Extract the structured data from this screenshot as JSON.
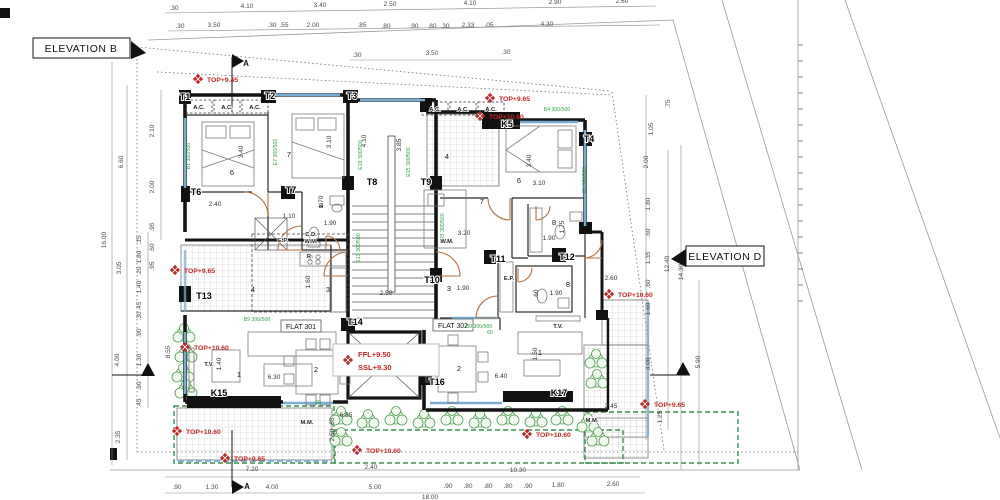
{
  "labels": {
    "elevation_b": "ELEVATION B",
    "elevation_d": "ELEVATION D",
    "flat_301": "FLAT 301",
    "flat_302": "FLAT 302"
  },
  "levels": {
    "ffl": "FFL+9.50",
    "ssl": "SSL+9.30"
  },
  "section_labels": [
    {
      "t": "A",
      "x": 246,
      "y": 66
    },
    {
      "t": "A",
      "x": 247,
      "y": 489
    }
  ],
  "red_markers": [
    {
      "t": "TOP+9.45",
      "x": 207,
      "y": 82
    },
    {
      "t": "TOP+9.65",
      "x": 499,
      "y": 101
    },
    {
      "t": "TOP+10.60",
      "x": 489,
      "y": 119
    },
    {
      "t": "TOP+9.65",
      "x": 184,
      "y": 273
    },
    {
      "t": "TOP+10.60",
      "x": 194,
      "y": 350
    },
    {
      "t": "TOP+10.60",
      "x": 186,
      "y": 434
    },
    {
      "t": "TOP+9.65",
      "x": 234,
      "y": 461
    },
    {
      "t": "TOP+10.60",
      "x": 366,
      "y": 453
    },
    {
      "t": "TOP+10.60",
      "x": 536,
      "y": 437
    },
    {
      "t": "TOP+10.60",
      "x": 618,
      "y": 297
    },
    {
      "t": "TOP+9.65",
      "x": 654,
      "y": 407
    }
  ],
  "columns": [
    {
      "t": "T1",
      "x": 185,
      "y": 100
    },
    {
      "t": "T2",
      "x": 270,
      "y": 99
    },
    {
      "t": "T3",
      "x": 352,
      "y": 99
    },
    {
      "t": "T4",
      "x": 589,
      "y": 142
    },
    {
      "t": "T6",
      "x": 196,
      "y": 195
    },
    {
      "t": "T7",
      "x": 291,
      "y": 193
    },
    {
      "t": "T8",
      "x": 372,
      "y": 185
    },
    {
      "t": "T9",
      "x": 426,
      "y": 185
    },
    {
      "t": "T10",
      "x": 432,
      "y": 283
    },
    {
      "t": "T11",
      "x": 498,
      "y": 262
    },
    {
      "t": "T12",
      "x": 567,
      "y": 260
    },
    {
      "t": "T13",
      "x": 204,
      "y": 299
    },
    {
      "t": "T14",
      "x": 355,
      "y": 325
    },
    {
      "t": "T16",
      "x": 437,
      "y": 385
    },
    {
      "t": "K5",
      "x": 507,
      "y": 127
    },
    {
      "t": "K15",
      "x": 219,
      "y": 396
    },
    {
      "t": "K17",
      "x": 559,
      "y": 396
    }
  ],
  "rooms": [
    {
      "t": "6",
      "x": 232,
      "y": 175
    },
    {
      "t": "7",
      "x": 289,
      "y": 157
    },
    {
      "t": "8",
      "x": 321,
      "y": 208
    },
    {
      "t": "3",
      "x": 328,
      "y": 292
    },
    {
      "t": "4",
      "x": 253,
      "y": 292
    },
    {
      "t": "1",
      "x": 239,
      "y": 377
    },
    {
      "t": "2",
      "x": 316,
      "y": 372
    },
    {
      "t": "4",
      "x": 447,
      "y": 159
    },
    {
      "t": "6",
      "x": 519,
      "y": 183
    },
    {
      "t": "7",
      "x": 482,
      "y": 204
    },
    {
      "t": "8",
      "x": 554,
      "y": 225
    },
    {
      "t": "8",
      "x": 568,
      "y": 287
    },
    {
      "t": "3",
      "x": 449,
      "y": 291
    },
    {
      "t": "1",
      "x": 540,
      "y": 355
    },
    {
      "t": "2",
      "x": 459,
      "y": 371
    }
  ],
  "annotations": [
    {
      "t": "A.C.",
      "x": 199,
      "y": 109
    },
    {
      "t": "A.C.",
      "x": 227,
      "y": 109
    },
    {
      "t": "A.C.",
      "x": 255,
      "y": 109
    },
    {
      "t": "A.C.",
      "x": 435,
      "y": 111
    },
    {
      "t": "A.C.",
      "x": 463,
      "y": 111
    },
    {
      "t": "A.C.",
      "x": 491,
      "y": 111
    },
    {
      "t": "E.P.",
      "x": 283,
      "y": 242
    },
    {
      "t": "E.P.",
      "x": 509,
      "y": 280
    },
    {
      "t": "C.D.",
      "x": 311,
      "y": 236
    },
    {
      "t": "W.M.",
      "x": 311,
      "y": 243
    },
    {
      "t": "W.M.",
      "x": 447,
      "y": 243
    },
    {
      "t": "T.V.",
      "x": 209,
      "y": 366
    },
    {
      "t": "T.V.",
      "x": 558,
      "y": 328
    },
    {
      "t": "M.M.",
      "x": 307,
      "y": 424
    },
    {
      "t": "M.M.",
      "x": 592,
      "y": 422
    },
    {
      "t": "R",
      "x": 309,
      "y": 258
    }
  ],
  "green_codes": [
    {
      "t": "B1 300/500",
      "x": 190,
      "y": 156,
      "r": -90
    },
    {
      "t": "E7 300/500",
      "x": 277,
      "y": 152,
      "r": -90
    },
    {
      "t": "E19 300/500",
      "x": 362,
      "y": 155,
      "r": -90
    },
    {
      "t": "E15 300/500",
      "x": 410,
      "y": 162,
      "r": -90
    },
    {
      "t": "B4 300/500",
      "x": 557,
      "y": 111
    },
    {
      "t": "E13 300/500",
      "x": 360,
      "y": 248,
      "r": -90
    },
    {
      "t": "E23 300/500",
      "x": 444,
      "y": 228,
      "r": -90
    },
    {
      "t": "E5 300/500",
      "x": 586,
      "y": 180,
      "r": -90
    },
    {
      "t": "B9 300/500",
      "x": 257,
      "y": 321
    },
    {
      "t": "B9 300/500",
      "x": 479,
      "y": 328
    },
    {
      "t": "60",
      "x": 318,
      "y": 404
    },
    {
      "t": "60",
      "x": 490,
      "y": 334
    }
  ],
  "dims_top": [
    {
      "t": ".30",
      "x": 174,
      "y": 10
    },
    {
      "t": "4.10",
      "x": 247,
      "y": 8
    },
    {
      "t": "3.40",
      "x": 320,
      "y": 7
    },
    {
      "t": "2.50",
      "x": 390,
      "y": 6
    },
    {
      "t": "4.10",
      "x": 470,
      "y": 5
    },
    {
      "t": "2.90",
      "x": 555,
      "y": 4
    },
    {
      "t": "2.60",
      "x": 622,
      "y": 3
    }
  ],
  "dims_top2": [
    {
      "t": ".30",
      "x": 180,
      "y": 28
    },
    {
      "t": "3.50",
      "x": 214,
      "y": 27
    },
    {
      "t": ".30",
      "x": 272,
      "y": 27
    },
    {
      "t": ".55",
      "x": 284,
      "y": 27
    },
    {
      "t": "2.00",
      "x": 313,
      "y": 27
    },
    {
      "t": ".85",
      "x": 362,
      "y": 27
    },
    {
      "t": ".80",
      "x": 386,
      "y": 28
    },
    {
      "t": ".90",
      "x": 414,
      "y": 28
    },
    {
      "t": ".80",
      "x": 432,
      "y": 28
    },
    {
      "t": ".30",
      "x": 445,
      "y": 28
    },
    {
      "t": "2.33",
      "x": 468,
      "y": 27
    },
    {
      "t": ".05",
      "x": 489,
      "y": 27
    },
    {
      "t": "4.30",
      "x": 547,
      "y": 26
    }
  ],
  "dims_top3": [
    {
      "t": ".30",
      "x": 357,
      "y": 57
    },
    {
      "t": "3.50",
      "x": 432,
      "y": 55
    },
    {
      "t": ".30",
      "x": 506,
      "y": 54
    }
  ],
  "dims_bottom": [
    {
      "t": "7.20",
      "x": 252,
      "y": 471
    },
    {
      "t": "2.40",
      "x": 371,
      "y": 469
    },
    {
      "t": "10.30",
      "x": 518,
      "y": 472
    }
  ],
  "dims_bottom2": [
    {
      "t": ".90",
      "x": 177,
      "y": 489
    },
    {
      "t": "1.30",
      "x": 212,
      "y": 489
    },
    {
      "t": "4.00",
      "x": 272,
      "y": 489
    },
    {
      "t": "5.00",
      "x": 375,
      "y": 489
    },
    {
      "t": ".90",
      "x": 448,
      "y": 488
    },
    {
      "t": ".80",
      "x": 468,
      "y": 488
    },
    {
      "t": ".80",
      "x": 488,
      "y": 488
    },
    {
      "t": ".80",
      "x": 508,
      "y": 488
    },
    {
      "t": ".90",
      "x": 528,
      "y": 488
    },
    {
      "t": "1.80",
      "x": 558,
      "y": 487
    },
    {
      "t": "2.60",
      "x": 613,
      "y": 486
    }
  ],
  "dims_bottom3": [
    {
      "t": "18.00",
      "x": 430,
      "y": 499
    }
  ],
  "dims_left": [
    {
      "t": "16.00",
      "x": 106,
      "y": 240,
      "r": -90
    },
    {
      "t": "6.60",
      "x": 123,
      "y": 162,
      "r": -90
    },
    {
      "t": "3.05",
      "x": 121,
      "y": 268,
      "r": -90
    },
    {
      "t": "4.00",
      "x": 119,
      "y": 360,
      "r": -90
    },
    {
      "t": "2.35",
      "x": 120,
      "y": 437,
      "r": -90
    },
    {
      "t": "2.10",
      "x": 154,
      "y": 131,
      "r": -90
    },
    {
      "t": "2.00",
      "x": 154,
      "y": 187,
      "r": -90
    },
    {
      "t": ".95",
      "x": 154,
      "y": 227,
      "r": -90
    },
    {
      "t": ".60",
      "x": 154,
      "y": 248,
      "r": -90
    },
    {
      "t": ".95",
      "x": 154,
      "y": 266,
      "r": -90
    },
    {
      "t": ".15",
      "x": 141,
      "y": 240,
      "r": -90
    },
    {
      "t": "1.80",
      "x": 141,
      "y": 257,
      "r": -90
    },
    {
      "t": ".20",
      "x": 141,
      "y": 271,
      "r": -90
    },
    {
      "t": "1.40",
      "x": 141,
      "y": 287,
      "r": -90
    },
    {
      "t": ".45",
      "x": 141,
      "y": 306,
      "r": -90
    },
    {
      "t": ".30",
      "x": 141,
      "y": 316,
      "r": -90
    },
    {
      "t": ".90",
      "x": 141,
      "y": 333,
      "r": -90
    },
    {
      "t": "1.30",
      "x": 141,
      "y": 360,
      "r": -90
    },
    {
      "t": ".90",
      "x": 141,
      "y": 386,
      "r": -90
    },
    {
      "t": ".45",
      "x": 141,
      "y": 403,
      "r": -90
    },
    {
      "t": "8.55",
      "x": 170,
      "y": 352,
      "r": -90
    }
  ],
  "dims_right": [
    {
      "t": ".75",
      "x": 670,
      "y": 104,
      "r": -90
    },
    {
      "t": "1.05",
      "x": 653,
      "y": 129,
      "r": -90
    },
    {
      "t": "2.00",
      "x": 648,
      "y": 162,
      "r": -90
    },
    {
      "t": "1.80",
      "x": 650,
      "y": 204,
      "r": -90
    },
    {
      "t": ".60",
      "x": 650,
      "y": 233,
      "r": -90
    },
    {
      "t": "1.35",
      "x": 650,
      "y": 258,
      "r": -90
    },
    {
      "t": ".60",
      "x": 650,
      "y": 284,
      "r": -90
    },
    {
      "t": "1.60",
      "x": 650,
      "y": 309,
      "r": -90
    },
    {
      "t": "3.00",
      "x": 650,
      "y": 364,
      "r": -90
    },
    {
      "t": "1.25",
      "x": 662,
      "y": 417,
      "r": -90
    },
    {
      "t": "12.40",
      "x": 669,
      "y": 264,
      "r": -90
    },
    {
      "t": "14.30",
      "x": 683,
      "y": 272,
      "r": -90
    },
    {
      "t": "5.90",
      "x": 700,
      "y": 362,
      "r": -90
    }
  ],
  "dims_inner": [
    {
      "t": "3.40",
      "x": 243,
      "y": 152,
      "r": -90
    },
    {
      "t": "3.10",
      "x": 331,
      "y": 142,
      "r": -90
    },
    {
      "t": "2.40",
      "x": 215,
      "y": 206
    },
    {
      "t": "1.10",
      "x": 289,
      "y": 218
    },
    {
      "t": "1.70",
      "x": 323,
      "y": 202,
      "r": -90
    },
    {
      "t": "1.90",
      "x": 330,
      "y": 225
    },
    {
      "t": "4.10",
      "x": 366,
      "y": 141,
      "r": -90
    },
    {
      "t": "3.85",
      "x": 401,
      "y": 145,
      "r": -90
    },
    {
      "t": "3.40",
      "x": 531,
      "y": 161,
      "r": -90
    },
    {
      "t": "3.10",
      "x": 539,
      "y": 185
    },
    {
      "t": "3.20",
      "x": 464,
      "y": 235
    },
    {
      "t": "1.60",
      "x": 310,
      "y": 282,
      "r": -90
    },
    {
      "t": "2.50",
      "x": 386,
      "y": 295
    },
    {
      "t": "1.90",
      "x": 463,
      "y": 290
    },
    {
      "t": "1.75",
      "x": 564,
      "y": 227,
      "r": -90
    },
    {
      "t": "1.90",
      "x": 549,
      "y": 240
    },
    {
      "t": ".60",
      "x": 538,
      "y": 294,
      "r": -90
    },
    {
      "t": "1.90",
      "x": 556,
      "y": 295
    },
    {
      "t": "1.40",
      "x": 221,
      "y": 364,
      "r": -90
    },
    {
      "t": "6.30",
      "x": 274,
      "y": 379
    },
    {
      "t": "6.40",
      "x": 501,
      "y": 378
    },
    {
      "t": "1.50",
      "x": 537,
      "y": 354,
      "r": -90
    },
    {
      "t": "6.85",
      "x": 346,
      "y": 417
    },
    {
      "t": "2.45",
      "x": 611,
      "y": 408
    },
    {
      "t": "2.60",
      "x": 611,
      "y": 280
    },
    {
      "t": ".65",
      "x": 334,
      "y": 422,
      "r": -90
    },
    {
      "t": "2.50",
      "x": 334,
      "y": 435,
      "r": -90
    }
  ]
}
